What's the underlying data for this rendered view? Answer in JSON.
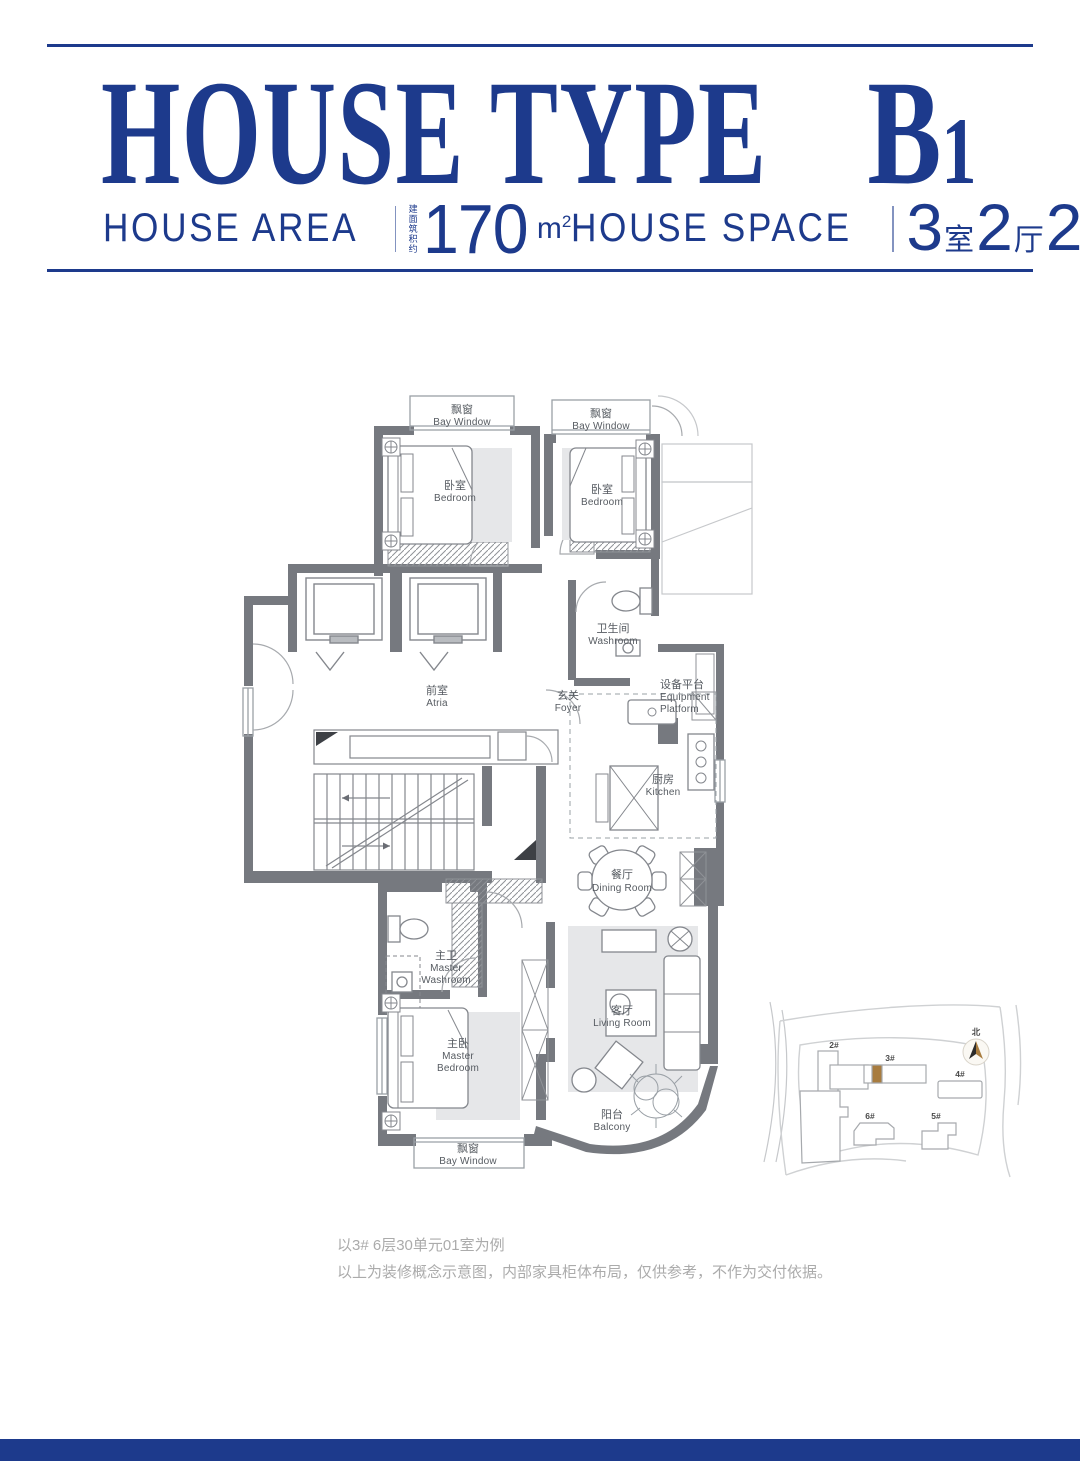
{
  "colors": {
    "accent": "#1d3a8c",
    "wall": "#76797f",
    "highlight": "#a87c3f"
  },
  "header": {
    "title": "HOUSE TYPE",
    "unit_letter": "B",
    "unit_number": "1",
    "area": {
      "label": "HOUSE AREA",
      "note_rows": [
        "建面",
        "筑积",
        "约"
      ],
      "value": "170",
      "unit_base": "m",
      "unit_sup": "2"
    },
    "space": {
      "label": "HOUSE SPACE",
      "segments": [
        {
          "num": "3",
          "cn": "室"
        },
        {
          "num": "2",
          "cn": "厅"
        },
        {
          "num": "2",
          "cn": "卫"
        }
      ]
    }
  },
  "plan": {
    "rooms": {
      "bay_window": {
        "cn": "飘窗",
        "en": "Bay Window"
      },
      "bedroom": {
        "cn": "卧室",
        "en": "Bedroom"
      },
      "washroom": {
        "cn": "卫生间",
        "en": "Washroom"
      },
      "atria": {
        "cn": "前室",
        "en": "Atria"
      },
      "foyer": {
        "cn": "玄关",
        "en": "Foyer"
      },
      "equipment_platform": {
        "cn": "设备平台",
        "en1": "Equipment",
        "en2": "Platform"
      },
      "kitchen": {
        "cn": "厨房",
        "en": "Kitchen"
      },
      "dining": {
        "cn": "餐厅",
        "en": "Dining Room"
      },
      "living": {
        "cn": "客厅",
        "en": "Living Room"
      },
      "master_washroom": {
        "cn": "主卫",
        "en1": "Master",
        "en2": "Washroom"
      },
      "master_bedroom": {
        "cn": "主卧",
        "en1": "Master",
        "en2": "Bedroom"
      },
      "balcony": {
        "cn": "阳台",
        "en": "Balcony"
      }
    }
  },
  "siteplan": {
    "north": "北",
    "buildings": [
      "2#",
      "3#",
      "4#",
      "5#",
      "6#"
    ]
  },
  "footnotes": [
    "以3# 6层30单元01室为例",
    "以上为装修概念示意图，内部家具柜体布局，仅供参考，不作为交付依据。"
  ]
}
